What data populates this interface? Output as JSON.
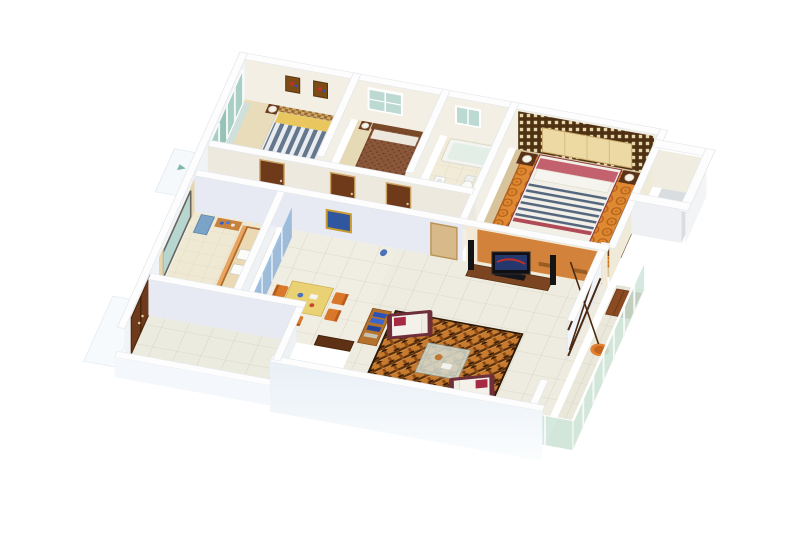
{
  "meta": {
    "caption": "3D isometric cutaway render of an apartment floor plan with furnished rooms",
    "projection": "isometric-cutaway",
    "background": "#ffffff"
  },
  "palette": {
    "wall_top": "#fdfdfd",
    "wall_face_cream": "#f3efe4",
    "wall_face_cool": "#e7eaf2",
    "wall_face_light": "#eef2f5",
    "floor_bedroom": "#e8dcba",
    "floor_master": "#d8c49c",
    "floor_tile": "#eeece0",
    "floor_bath": "#f1ebd8",
    "floor_corridor": "#e4d2a6",
    "glass_teal": "#a9cfc5",
    "railing_glass": "#cfe6db",
    "wood_dark": "#6b3a1d",
    "wood_mid": "#b06a2a",
    "wood_door": "#6e3a1b",
    "accent_orange": "#d2823a",
    "rug_master": "#df8a32",
    "rug_living": "#c87b2e",
    "bed_stripe_navy": "#64778c",
    "blanket_navy": "#55677e",
    "pillow_red": "#c4616e",
    "sofa_maroon": "#6e2f3a",
    "cushion_red": "#a62a42",
    "bed_yellow": "#e9c75e",
    "table_yellow": "#ead173",
    "chair_orange": "#d9772b",
    "item_blue": "#4a72b8",
    "lounge_orange": "#e08030"
  },
  "rooms": [
    {
      "id": "bedroom-2",
      "label": "Bedroom 2",
      "furniture": [
        "sliding wardrobe (teal glass)",
        "double bed with striped cover",
        "checkered headboard",
        "two nightstands with lamps",
        "two framed pictures",
        "orange bench"
      ]
    },
    {
      "id": "bedroom-3",
      "label": "Bedroom 3",
      "furniture": [
        "bed with brown patterned cover",
        "nightstands with lamps",
        "window"
      ]
    },
    {
      "id": "bathroom",
      "label": "Bathroom",
      "furniture": [
        "bathtub",
        "toilet",
        "washbasin",
        "window"
      ]
    },
    {
      "id": "master-bedroom",
      "label": "Master Bedroom",
      "furniture": [
        "double bed with navy striped blanket",
        "lattice screen headboard wall",
        "padded cream headboard",
        "nightstands with lamps",
        "orange swirl rug",
        "dark wardrobe"
      ]
    },
    {
      "id": "corridor",
      "label": "Corridor",
      "furniture": [
        "wooden doors"
      ]
    },
    {
      "id": "kitchen",
      "label": "Kitchen",
      "furniture": [
        "counter with twin sinks",
        "wall shelf with blue jars",
        "blue cabinet",
        "window with curtains"
      ]
    },
    {
      "id": "dining",
      "label": "Dining Area",
      "furniture": [
        "yellow dining table",
        "orange chairs",
        "blue glass partition",
        "wall picture",
        "blue vase",
        "dark sideboard"
      ]
    },
    {
      "id": "entry",
      "label": "Entry / Utility Room",
      "furniture": [
        "double entry door",
        "tiled floor",
        "low parapet"
      ]
    },
    {
      "id": "living-room",
      "label": "Living Room",
      "furniture": [
        "woven orange area rug",
        "two white sofas with maroon frames",
        "glass coffee table",
        "TV console with TV",
        "floor speakers",
        "bookshelf with blue books",
        "orange TV accent wall"
      ]
    },
    {
      "id": "balcony",
      "label": "Balcony",
      "furniture": [
        "glass railing",
        "orange lounge chair",
        "wooden deck",
        "dark lattice screen"
      ]
    },
    {
      "id": "utility-shaft",
      "label": "Utility Shaft",
      "furniture": []
    }
  ]
}
